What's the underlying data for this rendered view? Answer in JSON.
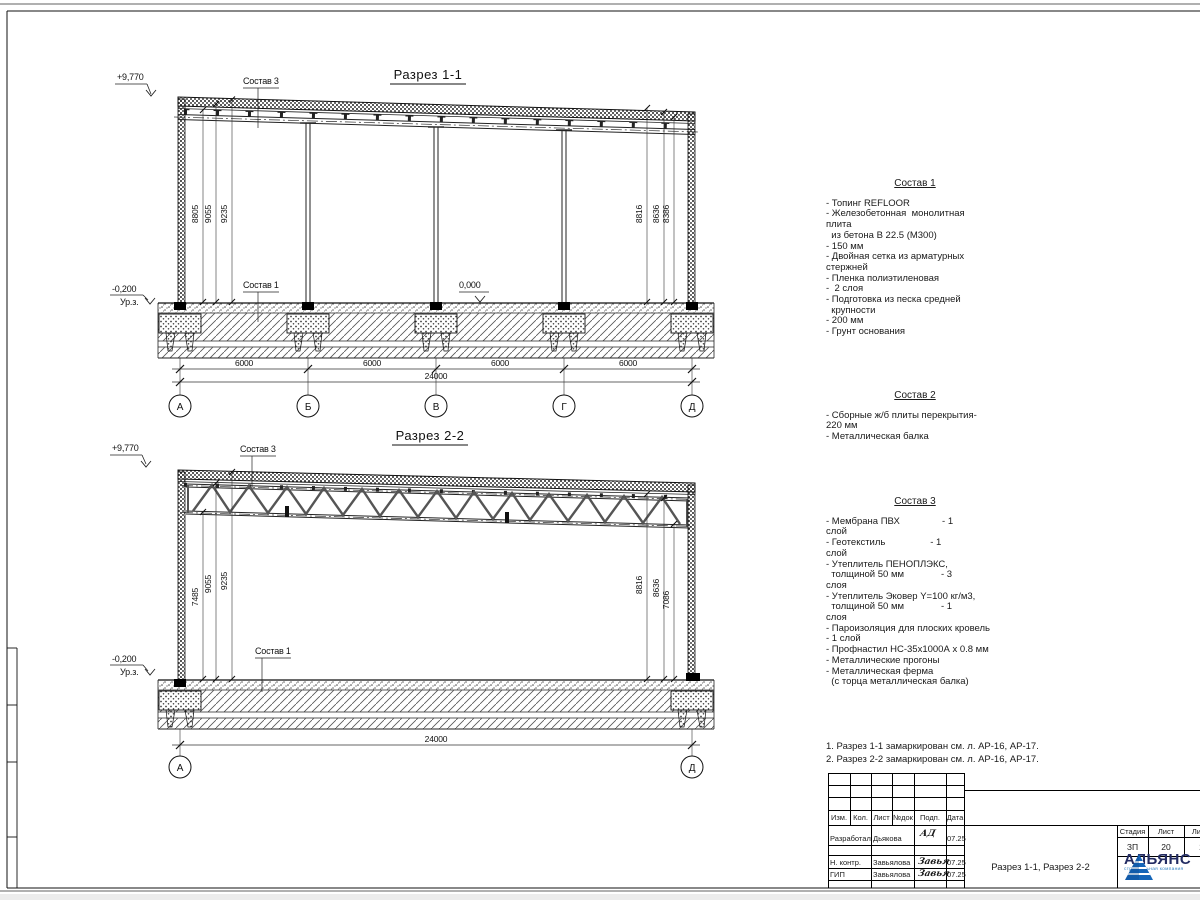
{
  "section1": {
    "title": "Разрез 1-1",
    "elev_top": "+9,770",
    "elev_minus": "-0,200",
    "ground_label": "Ур.з.",
    "elev_zero": "0,000",
    "sostav3_label": "Состав 3",
    "sostav1_label": "Состав 1",
    "dims_left": [
      "8805",
      "9055",
      "9235"
    ],
    "dims_right": [
      "8816",
      "8636",
      "8386"
    ],
    "bay_dim": "6000",
    "total_dim": "24000",
    "axes": [
      "А",
      "Б",
      "В",
      "Г",
      "Д"
    ]
  },
  "section2": {
    "title": "Разрез 2-2",
    "elev_top": "+9,770",
    "elev_minus": "-0,200",
    "ground_label": "Ур.з.",
    "sostav3_label": "Состав 3",
    "sostav1_label": "Состав 1",
    "dims_left": [
      "7485",
      "9055",
      "9235"
    ],
    "dims_right": [
      "8816",
      "8636",
      "7086"
    ],
    "total_dim": "24000",
    "axes": [
      "А",
      "Д"
    ]
  },
  "compositions": [
    {
      "heading": "Состав 1",
      "lines": [
        "- Топинг REFLOOR",
        "- Железобетонная  монолитная",
        "плита",
        "  из бетона В 22.5 (М300)",
        "- 150 мм",
        "- Двойная сетка из арматурных",
        "стержней",
        "- Пленка полиэтиленовая",
        "-  2 слоя",
        "- Подготовка из песка средней",
        "  крупности",
        "- 200 мм",
        "- Грунт основания"
      ]
    },
    {
      "heading": "Состав 2",
      "lines": [
        "- Сборные ж/б плиты перекрытия-",
        "220 мм",
        "- Металлическая балка"
      ]
    },
    {
      "heading": "Состав 3",
      "lines": [
        "- Мембрана ПВХ                - 1",
        "слой",
        "- Геотекстиль                 - 1",
        "слой",
        "- Утеплитель ПЕНОПЛЭКС,",
        "  толщиной 50 мм              - 3",
        "слоя",
        "- Утеплитель Эковер Y=100 кг/м3,",
        "  толщиной 50 мм              - 1",
        "слоя",
        "- Пароизоляция для плоских кровель",
        "- 1 слой",
        "- Профнастил НС-35х1000А х 0.8 мм",
        "- Металлические прогоны",
        "- Металлическая ферма",
        "  (с торца металлическая балка)"
      ]
    }
  ],
  "notes": [
    "1. Разрез 1-1 замаркирован см. л. АР-16, АР-17.",
    "2. Разрез 2-2 замаркирован см. л. АР-16, АР-17."
  ],
  "titleblock": {
    "header_cols": [
      "Изм.",
      "Кол.",
      "Лист",
      "№док",
      "Подп.",
      "Дата"
    ],
    "rows": [
      {
        "role": "Разработал",
        "name": "Дьякова",
        "sig": "АД",
        "date": "07.25"
      },
      {
        "role": "Н. контр.",
        "name": "Завьялова",
        "sig": "Завья",
        "date": "07.25"
      },
      {
        "role": "ГИП",
        "name": "Завьялова",
        "sig": "Завья",
        "date": "07.25"
      }
    ],
    "stage_label": "Стадия",
    "sheet_label": "Лист",
    "sheets_label": "Листов",
    "stage": "ЗП",
    "sheet_no": "20",
    "sheets_total": "20",
    "doc_title": "Разрез 1-1, Разрез 2-2",
    "logo": {
      "name": "АЛЬЯНС",
      "sub": "строительная компания",
      "triangle_color": "#1565b8",
      "text_color": "#232c63",
      "sub_color": "#2f7fc1"
    }
  }
}
